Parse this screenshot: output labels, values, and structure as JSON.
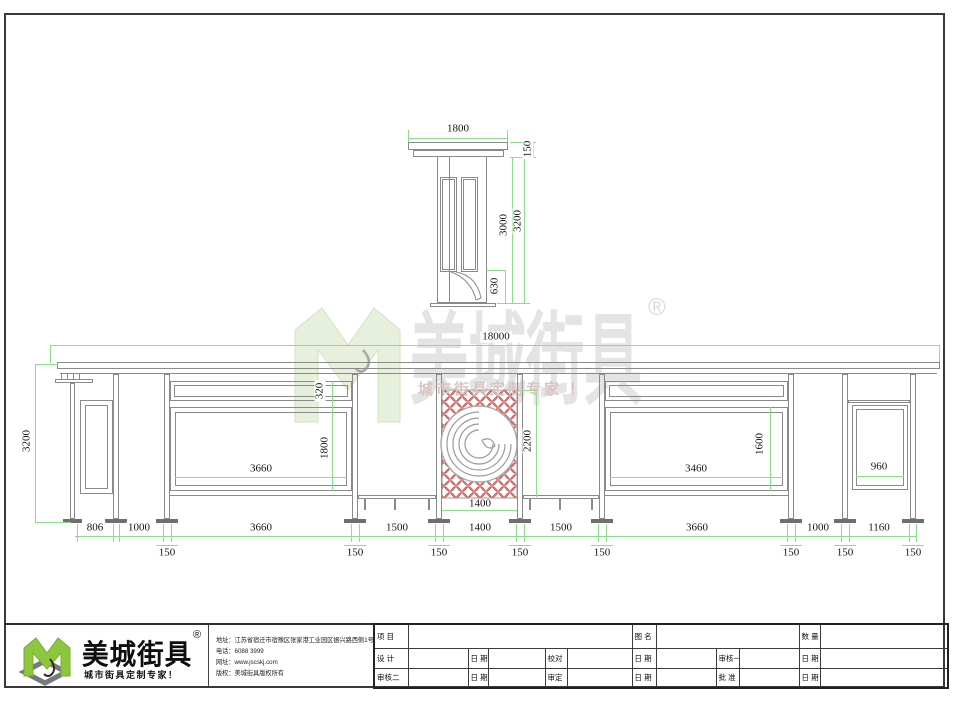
{
  "watermark": {
    "brand": "美城街具",
    "registered": "®",
    "slogan": "城市街具定制专家 ！"
  },
  "side_view": {
    "width": "1800",
    "roof_thickness": "150",
    "column_height": "3000",
    "total_height": "3200",
    "bench_height": "630"
  },
  "elevation": {
    "total_width": "18000",
    "total_height": "3200",
    "strip_height": "320",
    "left_panel_height": "1800",
    "left_panel_width": "3660",
    "totem_height": "2200",
    "totem_width": "1400",
    "right_panel_width": "3460",
    "right_panel_height": "1600",
    "end_panel_width": "960",
    "bay_dims": [
      "806",
      "1000",
      "3660",
      "1500",
      "1400",
      "1500",
      "3660",
      "1000",
      "1160"
    ],
    "post_dims": [
      "150",
      "150",
      "150",
      "150",
      "150",
      "150",
      "150",
      "150"
    ]
  },
  "footer": {
    "logo": {
      "brand": "美城街具",
      "registered": "®",
      "slogan": "城市街具定制专家！"
    },
    "contact": {
      "address": "地址：江苏省宿迁市宿豫区张家港工业园区振兴路西侧1号",
      "phone": "电话：6088 3999",
      "website": "网址：www.jscskj.com",
      "copyright": "版权：美城街具版权所有"
    },
    "title_block": {
      "row1": [
        "项 目",
        "图 名",
        "数 量"
      ],
      "row2": [
        "设 计",
        "日 期",
        "校对",
        "日 期",
        "审核一",
        "日 期"
      ],
      "row3": [
        "审核二",
        "日 期",
        "审定",
        "日 期",
        "批 准",
        "日 期"
      ]
    }
  }
}
